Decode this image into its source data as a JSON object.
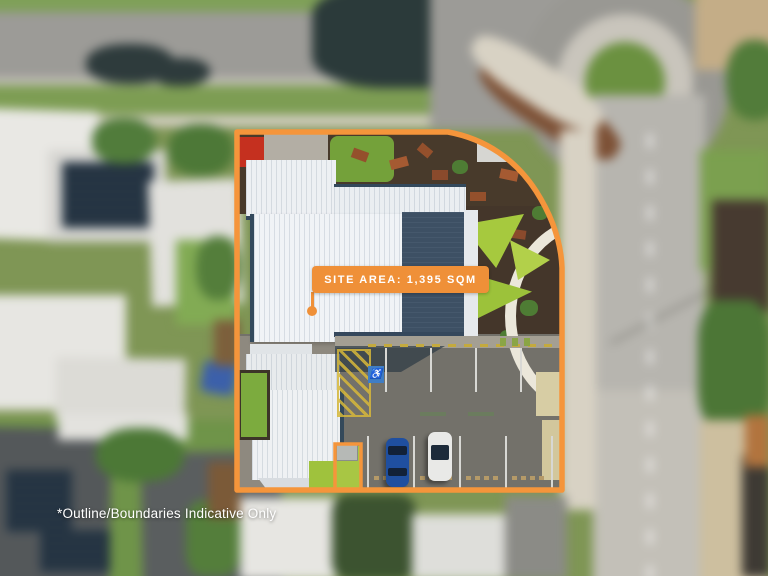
{
  "overlay": {
    "site_area_label": "SITE AREA: 1,395 SQM",
    "disclaimer": "*Outline/Boundaries Indicative Only",
    "accessible_symbol": "♿"
  },
  "colors": {
    "boundary_orange": "#F5953B",
    "badge_orange": "#EF9038",
    "badge_text": "#FFFFFF",
    "disclaimer_text": "#FFFFFF"
  }
}
